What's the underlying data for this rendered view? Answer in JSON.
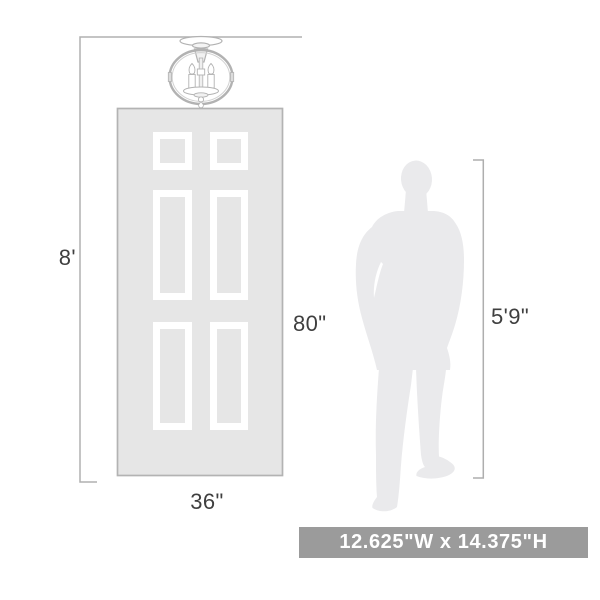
{
  "labels": {
    "ceiling_height": "8'",
    "door_height": "80\"",
    "door_width": "36\"",
    "person_height": "5'9\""
  },
  "badge": {
    "text": "12.625\"W x 14.375\"H"
  },
  "illustrations": {
    "light_fixture": "3-light-caged-semi-flush-ceiling-light",
    "door": "six-panel-door",
    "person": "standing-man-silhouette"
  },
  "colors": {
    "door_fill": "#e6e6e6",
    "door_border": "#b3b3b3",
    "panel_outline": "#ffffff",
    "silhouette_fill": "#eaeaec",
    "fixture_line": "#b2b2b2",
    "dimension_line": "#aeaeae",
    "label_text": "#3f3f3f",
    "badge_bg": "#9b9b9b",
    "badge_text": "#ffffff"
  }
}
